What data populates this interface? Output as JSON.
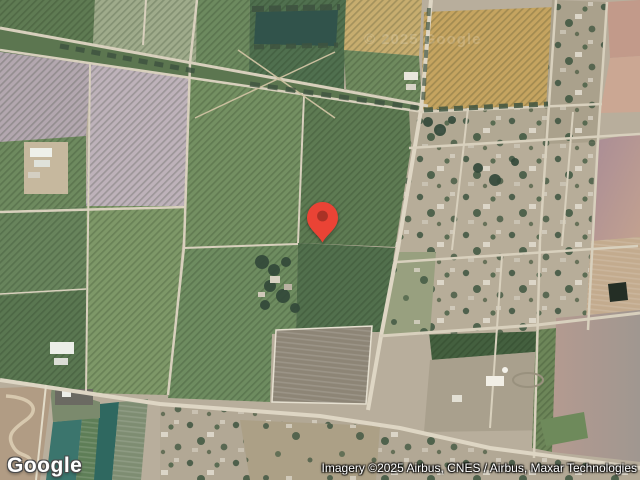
{
  "map": {
    "watermark": "© 2025 Google",
    "pin_color": "#EA4335",
    "pin_inner_color": "#A93226",
    "road_color": "#d8d0bd"
  },
  "footer": {
    "logo": "Google",
    "attribution": "Imagery ©2025 Airbus, CNES / Airbus, Maxar Technologies"
  }
}
